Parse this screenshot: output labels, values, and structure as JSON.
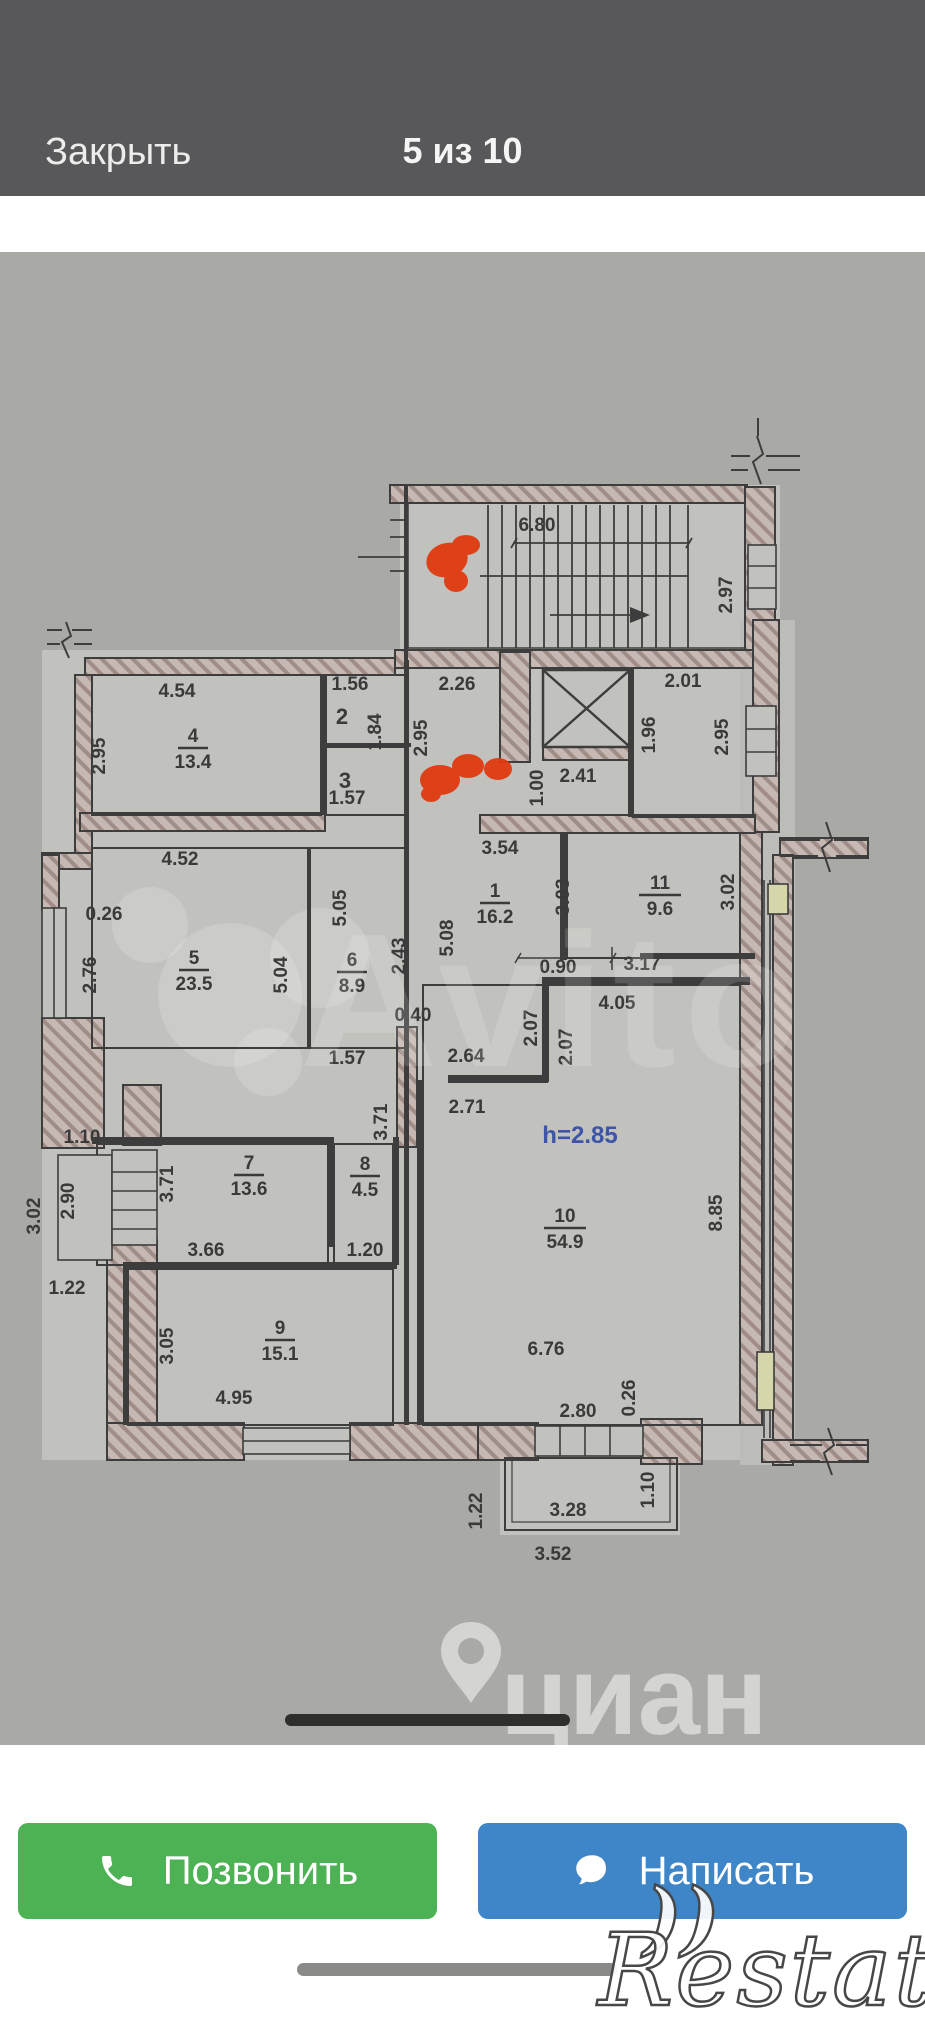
{
  "header": {
    "close_label": "Закрыть",
    "counter": "5 из 10"
  },
  "photo": {
    "watermarks": {
      "avito": "Avito",
      "cian": "циан",
      "restate": "Restate"
    },
    "floorplan": {
      "dims": [
        {
          "t": "6.80",
          "x": 537,
          "y": 531
        },
        {
          "t": "2.97",
          "x": 732,
          "y": 595,
          "r": -90
        },
        {
          "t": "2.26",
          "x": 457,
          "y": 690
        },
        {
          "t": "1.56",
          "x": 350,
          "y": 690
        },
        {
          "t": "2.01",
          "x": 683,
          "y": 687
        },
        {
          "t": "4.54",
          "x": 177,
          "y": 697
        },
        {
          "t": "2",
          "x": 342,
          "y": 724,
          "s": 22
        },
        {
          "t": "1.84",
          "x": 381,
          "y": 732,
          "r": -90
        },
        {
          "t": "2.95",
          "x": 105,
          "y": 756,
          "r": -90
        },
        {
          "t": "2.95",
          "x": 427,
          "y": 738,
          "r": -90
        },
        {
          "t": "1.96",
          "x": 655,
          "y": 735,
          "r": -90
        },
        {
          "t": "2.95",
          "x": 728,
          "y": 737,
          "r": -90
        },
        {
          "t": "2.41",
          "x": 578,
          "y": 782
        },
        {
          "t": "1.00",
          "x": 543,
          "y": 788,
          "r": -90
        },
        {
          "t": "3",
          "x": 345,
          "y": 788,
          "s": 22
        },
        {
          "t": "1.57",
          "x": 347,
          "y": 804
        },
        {
          "t": "4.52",
          "x": 180,
          "y": 865
        },
        {
          "t": "3.54",
          "x": 500,
          "y": 854
        },
        {
          "t": "0.26",
          "x": 104,
          "y": 920
        },
        {
          "t": "2.76",
          "x": 96,
          "y": 975,
          "r": -90
        },
        {
          "t": "5.05",
          "x": 346,
          "y": 908,
          "r": -90
        },
        {
          "t": "5.04",
          "x": 287,
          "y": 975,
          "r": -90
        },
        {
          "t": "2.43",
          "x": 405,
          "y": 956,
          "r": -90
        },
        {
          "t": "5.08",
          "x": 453,
          "y": 938,
          "r": -90
        },
        {
          "t": "3.03",
          "x": 569,
          "y": 897,
          "r": -90
        },
        {
          "t": "3.02",
          "x": 734,
          "y": 892,
          "r": -90
        },
        {
          "t": "0.90",
          "x": 558,
          "y": 973
        },
        {
          "t": "3.17",
          "x": 642,
          "y": 970
        },
        {
          "t": "0.40",
          "x": 413,
          "y": 1021
        },
        {
          "t": "4.05",
          "x": 617,
          "y": 1009
        },
        {
          "t": "2.07",
          "x": 537,
          "y": 1028,
          "r": -90
        },
        {
          "t": "2.07",
          "x": 572,
          "y": 1047,
          "r": -90
        },
        {
          "t": "1.57",
          "x": 347,
          "y": 1064
        },
        {
          "t": "2.64",
          "x": 466,
          "y": 1062
        },
        {
          "t": "1.10",
          "x": 82,
          "y": 1143
        },
        {
          "t": "2.71",
          "x": 467,
          "y": 1113
        },
        {
          "t": "h=2.85",
          "x": 580,
          "y": 1143,
          "c": "blue",
          "s": 24
        },
        {
          "t": "3.71",
          "x": 173,
          "y": 1184,
          "r": -90
        },
        {
          "t": "3.71",
          "x": 387,
          "y": 1122,
          "r": -90
        },
        {
          "t": "8.85",
          "x": 722,
          "y": 1213,
          "r": -90
        },
        {
          "t": "2.90",
          "x": 74,
          "y": 1201,
          "r": -90
        },
        {
          "t": "3.02",
          "x": 40,
          "y": 1216,
          "r": -90
        },
        {
          "t": "3.66",
          "x": 206,
          "y": 1256
        },
        {
          "t": "1.20",
          "x": 365,
          "y": 1256
        },
        {
          "t": "1.22",
          "x": 67,
          "y": 1294
        },
        {
          "t": "3.05",
          "x": 173,
          "y": 1346,
          "r": -90
        },
        {
          "t": "4.95",
          "x": 234,
          "y": 1404
        },
        {
          "t": "6.76",
          "x": 546,
          "y": 1355
        },
        {
          "t": "0.26",
          "x": 635,
          "y": 1398,
          "r": -90
        },
        {
          "t": "2.80",
          "x": 578,
          "y": 1417
        },
        {
          "t": "1.22",
          "x": 482,
          "y": 1511,
          "r": -90
        },
        {
          "t": "3.28",
          "x": 568,
          "y": 1516
        },
        {
          "t": "1.10",
          "x": 654,
          "y": 1490,
          "r": -90
        },
        {
          "t": "3.52",
          "x": 553,
          "y": 1560
        }
      ],
      "rooms": [
        {
          "num": "4",
          "area": "13.4",
          "x": 193,
          "y": 742
        },
        {
          "num": "1",
          "area": "16.2",
          "x": 495,
          "y": 897
        },
        {
          "num": "11",
          "area": "9.6",
          "x": 660,
          "y": 889
        },
        {
          "num": "5",
          "area": "23.5",
          "x": 194,
          "y": 964
        },
        {
          "num": "6",
          "area": "8.9",
          "x": 352,
          "y": 966
        },
        {
          "num": "7",
          "area": "13.6",
          "x": 249,
          "y": 1169
        },
        {
          "num": "8",
          "area": "4.5",
          "x": 365,
          "y": 1170
        },
        {
          "num": "9",
          "area": "15.1",
          "x": 280,
          "y": 1334
        },
        {
          "num": "10",
          "area": "54.9",
          "x": 565,
          "y": 1222
        }
      ]
    }
  },
  "actions": {
    "call_label": "Позвонить",
    "write_label": "Написать"
  },
  "colors": {
    "header_bg": "#58585a",
    "accent_green": "#4cb254",
    "accent_blue": "#3f86c8",
    "note_blue": "#3d54a8",
    "scribble_red": "#e03a10"
  }
}
